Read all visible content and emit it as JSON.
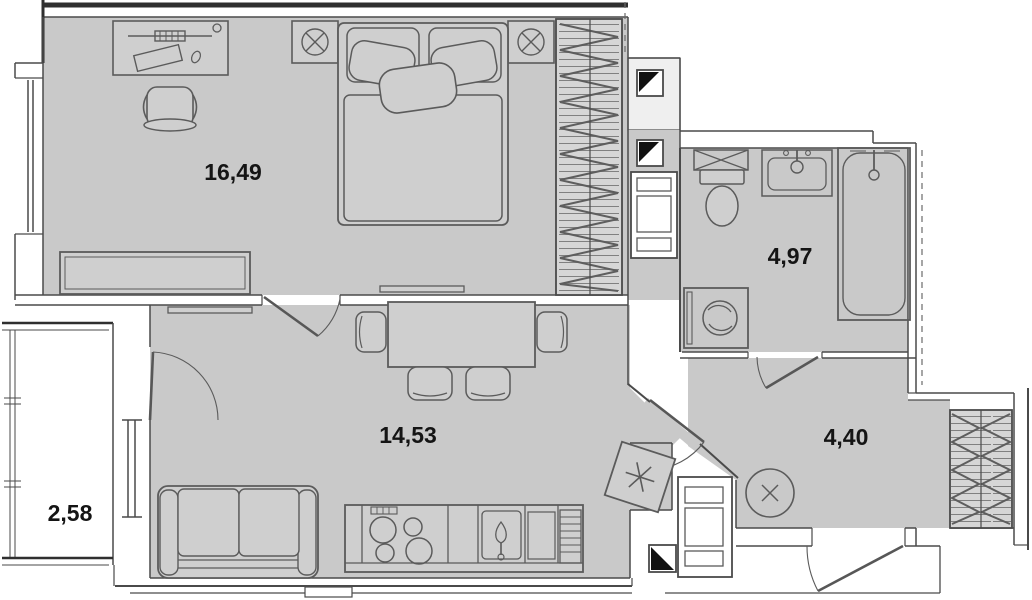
{
  "plan": {
    "type": "apartment-floor-plan",
    "rooms": [
      {
        "id": "bedroom",
        "area_label": "16,49"
      },
      {
        "id": "living-kitchen",
        "area_label": "14,53"
      },
      {
        "id": "bathroom",
        "area_label": "4,97"
      },
      {
        "id": "hallway",
        "area_label": "4,40"
      },
      {
        "id": "balcony",
        "area_label": "2,58"
      }
    ],
    "colors": {
      "floor": "#c9c9c9",
      "wall_line": "#4a4a4a",
      "background": "#ffffff",
      "vent_mark": "#111111"
    },
    "symbols": [
      "double-bed",
      "pillows",
      "nightstand-lamp-left",
      "nightstand-lamp-right",
      "wardrobe-hatched",
      "desk",
      "office-chair",
      "dresser",
      "tv-bedroom",
      "tv-living",
      "dining-table",
      "dining-chairs",
      "sofa",
      "kitchen-counter",
      "stove-burners",
      "kitchen-sink",
      "dish-rack",
      "refrigerator-snowflake",
      "vent-shaft",
      "duct-riser",
      "towel-rail-x",
      "toilet",
      "wash-basin",
      "bathtub",
      "washing-machine",
      "hall-mirror-x",
      "hall-wardrobe-hatched",
      "entrance-door",
      "balcony-window",
      "balcony-door"
    ]
  }
}
